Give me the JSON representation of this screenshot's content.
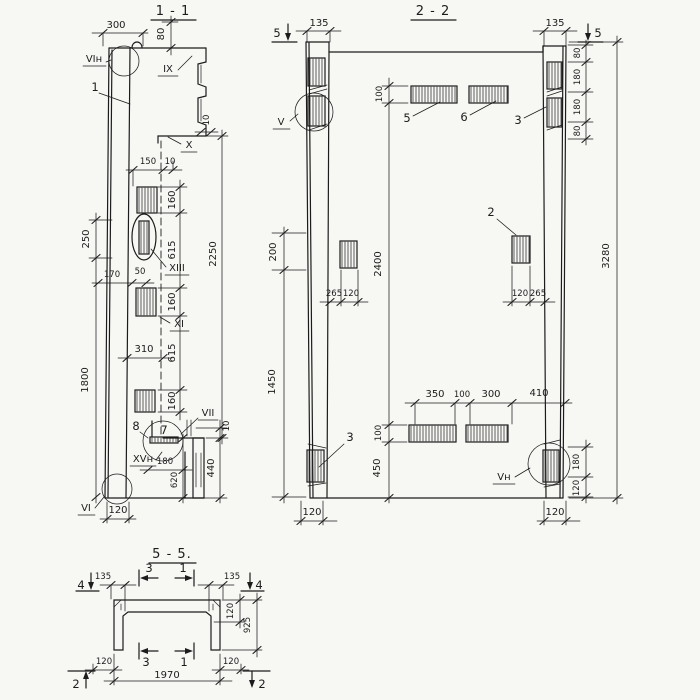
{
  "drawing": {
    "background": "#f7f7f4",
    "ink": "#1c1c1c",
    "s11": {
      "title": "1 - 1",
      "labels": {
        "vi_n": "VIн",
        "pos1": "1",
        "ix": "IX",
        "x": "X",
        "xiii": "XIII",
        "xi": "XI",
        "pos8": "8",
        "pos7": "7",
        "vii": "VII",
        "xv_n": "XVн",
        "vi": "VI"
      },
      "dims": {
        "d300": "300",
        "d80": "80",
        "d10_top": "10",
        "d150": "150",
        "d10_mid": "10",
        "d160_1": "160",
        "d615_1": "615",
        "d160_2": "160",
        "d615_2": "615",
        "d160_3": "160",
        "d2250": "2250",
        "d250": "250",
        "d170": "170",
        "d50": "50",
        "d1800": "1800",
        "d310": "310",
        "d180": "180",
        "d620": "620",
        "d10_bot": "10",
        "d440": "440",
        "d120": "120"
      }
    },
    "s22": {
      "title": "2 - 2",
      "labels": {
        "v": "V",
        "vn": "Vн",
        "pos2": "2",
        "pos3_top": "3",
        "pos3_bottom": "3",
        "pos5": "5",
        "pos6": "6"
      },
      "cut_marks": {
        "left5": "5",
        "right5": "5"
      },
      "dims": {
        "d135_l": "135",
        "d135_r": "135",
        "d80_a": "80",
        "d180_a": "180",
        "d180_b": "180",
        "d80_b": "80",
        "d3280": "3280",
        "d100_top": "100",
        "d200": "200",
        "d2400": "2400",
        "d265_l": "265",
        "d120_lm": "120",
        "d120_rm": "120",
        "d265_r": "265",
        "d1450": "1450",
        "d350": "350",
        "d100_bm": "100",
        "d300": "300",
        "d410": "410",
        "d100_b": "100",
        "d450": "450",
        "d180_br": "180",
        "d120_br": "120",
        "d120_bl_col": "120",
        "d120_br_col": "120"
      }
    },
    "s55": {
      "title": "5 - 5.",
      "cut_marks": {
        "left4": "4",
        "right4": "4",
        "top3": "3",
        "top1": "1",
        "bottom3": "3",
        "bottom1": "1",
        "left2": "2",
        "right2": "2"
      },
      "dims": {
        "d135_l": "135",
        "d135_r": "135",
        "d120_slab": "120",
        "d925": "925",
        "d120_bl": "120",
        "d120_br": "120",
        "d1970": "1970"
      }
    }
  }
}
